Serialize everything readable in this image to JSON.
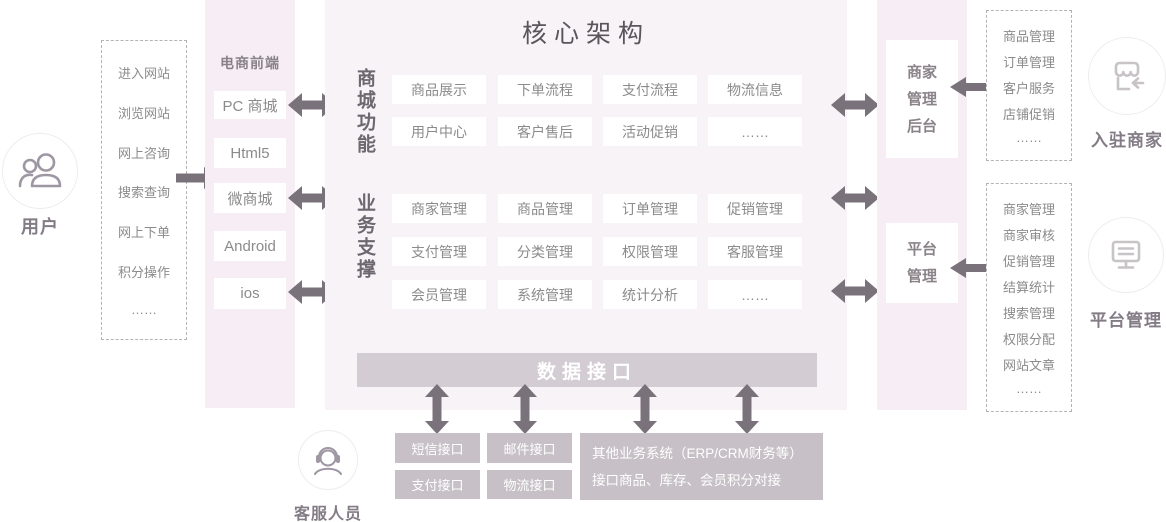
{
  "colors": {
    "panel_bg": "#f8f3f7",
    "column_bg": "#f6eef4",
    "arrow": "#7a727a",
    "data_bar_bg": "#d3ccd2",
    "interface_box_bg": "#c7c0c6",
    "box_text": "#8b8b8b",
    "label_text": "#837c86"
  },
  "user": {
    "icon": "users-icon",
    "label": "用户",
    "actions": [
      "进入网站",
      "浏览网站",
      "网上咨询",
      "搜索查询",
      "网上下单",
      "积分操作",
      "……"
    ]
  },
  "frontend": {
    "header": "电商前端",
    "items": [
      "PC 商城",
      "Html5",
      "微商城",
      "Android",
      "ios"
    ]
  },
  "core": {
    "title": "核心架构",
    "mall": {
      "label": "商城功能",
      "rows": [
        [
          "商品展示",
          "下单流程",
          "支付流程",
          "物流信息"
        ],
        [
          "用户中心",
          "客户售后",
          "活动促销",
          "……"
        ]
      ]
    },
    "support": {
      "label": "业务支撑",
      "rows": [
        [
          "商家管理",
          "商品管理",
          "订单管理",
          "促销管理"
        ],
        [
          "支付管理",
          "分类管理",
          "权限管理",
          "客服管理"
        ],
        [
          "会员管理",
          "系统管理",
          "统计分析",
          "……"
        ]
      ]
    },
    "data_bar": "数据接口"
  },
  "interfaces": {
    "boxes": [
      "短信接口",
      "邮件接口",
      "支付接口",
      "物流接口"
    ],
    "other": {
      "line1": "其他业务系统（ERP/CRM财务等）",
      "line2": "接口商品、库存、会员积分对接"
    }
  },
  "service": {
    "icon": "headset-icon",
    "label": "客服人员"
  },
  "merchant_backend": {
    "lines": [
      "商家",
      "管理",
      "后台"
    ]
  },
  "platform_box": {
    "lines": [
      "平台",
      "管理"
    ]
  },
  "merchant_panel": {
    "items": [
      "商品管理",
      "订单管理",
      "客户服务",
      "店铺促销",
      "……"
    ]
  },
  "platform_panel": {
    "items": [
      "商家管理",
      "商家审核",
      "促销管理",
      "结算统计",
      "搜索管理",
      "权限分配",
      "网站文章",
      "……"
    ]
  },
  "merchant": {
    "icon": "storefront-icon",
    "label": "入驻商家"
  },
  "platform": {
    "icon": "monitor-icon",
    "label": "平台管理"
  }
}
